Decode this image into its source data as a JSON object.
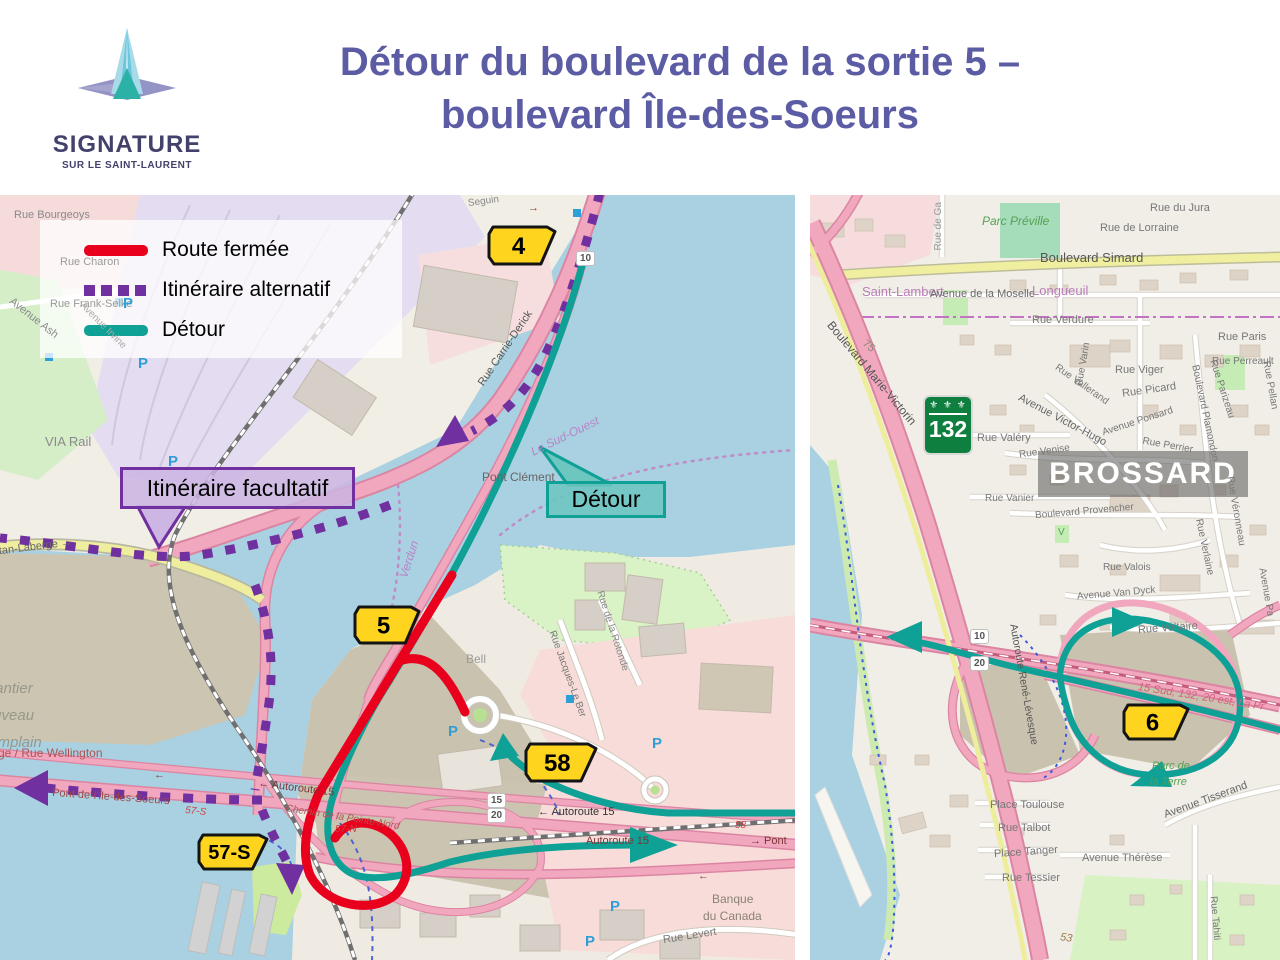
{
  "header": {
    "title_line1": "Détour du boulevard de la sortie 5 –",
    "title_line2": "boulevard Île-des-Soeurs",
    "title_color": "#5c5ca5",
    "logo_name": "SIGNATURE",
    "logo_subtitle": "SUR LE SAINT-LAURENT"
  },
  "palette": {
    "badge_yellow": "#ffd41e",
    "badge_border": "#141414",
    "shield_green": "#0f7f3f"
  },
  "legend": {
    "items": [
      {
        "label": "Route fermée",
        "color": "#e8001d",
        "style": "solid"
      },
      {
        "label": "Itinéraire alternatif",
        "color": "#7030a0",
        "style": "dashed"
      },
      {
        "label": "Détour",
        "color": "#0fa096",
        "style": "solid"
      }
    ]
  },
  "left_map": {
    "callouts": [
      {
        "text": "Itinéraire facultatif",
        "type": "alternative-route-callout"
      },
      {
        "text": "Détour",
        "type": "detour-callout"
      }
    ],
    "badges": [
      {
        "label": "4",
        "x": 487,
        "y": 30,
        "w": 70,
        "h": 41
      },
      {
        "label": "5",
        "x": 353,
        "y": 410,
        "w": 68,
        "h": 40
      },
      {
        "label": "58",
        "x": 524,
        "y": 547,
        "w": 74,
        "h": 41
      },
      {
        "label": "57-S",
        "x": 197,
        "y": 638,
        "w": 72,
        "h": 38
      }
    ],
    "road_plates": [
      {
        "label": "10",
        "x": 576,
        "y": 56
      },
      {
        "label": "15",
        "x": 487,
        "y": 598
      },
      {
        "label": "20",
        "x": 487,
        "y": 613
      }
    ],
    "p_marker_label": "P",
    "p_positions": [
      {
        "x": 123,
        "y": 100
      },
      {
        "x": 138,
        "y": 160
      },
      {
        "x": 168,
        "y": 258
      },
      {
        "x": 448,
        "y": 528
      },
      {
        "x": 652,
        "y": 540
      },
      {
        "x": 610,
        "y": 703
      },
      {
        "x": 585,
        "y": 738
      }
    ],
    "labels": [
      {
        "t": "Rue Bourgeoys",
        "x": 14,
        "y": 15,
        "s": 11,
        "c": "#8a8a8a"
      },
      {
        "t": "Seguin",
        "x": 468,
        "y": 2,
        "s": 10,
        "c": "#888",
        "rot": -8
      },
      {
        "t": "Rue Charon",
        "x": 60,
        "y": 62,
        "s": 11,
        "c": "#9a9a9a"
      },
      {
        "t": "Rue Frank-Selke",
        "x": 50,
        "y": 104,
        "s": 11,
        "c": "#9a9a9a"
      },
      {
        "t": "Avenue Ash",
        "x": 4,
        "y": 118,
        "s": 11,
        "c": "#8a8a8a",
        "rot": 38
      },
      {
        "t": "Avenue Irvine",
        "x": 72,
        "y": 126,
        "s": 10,
        "c": "#aaa",
        "rot": 45
      },
      {
        "t": "VIA Rail",
        "x": 45,
        "y": 240,
        "s": 13,
        "c": "#8a8a8a"
      },
      {
        "t": "Rue Carrie-Derick",
        "x": 462,
        "y": 148,
        "s": 11,
        "c": "#555",
        "rot": -56
      },
      {
        "t": "Pont Clément",
        "x": 482,
        "y": 276,
        "s": 12,
        "c": "#666"
      },
      {
        "t": "Le Sud-Ouest",
        "x": 528,
        "y": 235,
        "s": 12,
        "c": "#b884c8",
        "rot": -26,
        "it": 1
      },
      {
        "t": "Verdun",
        "x": 390,
        "y": 358,
        "s": 12,
        "c": "#b884c8",
        "rot": -72,
        "it": 1
      },
      {
        "t": "Gaétan-Laberge  →",
        "x": -22,
        "y": 348,
        "s": 11,
        "c": "#666",
        "rot": -7
      },
      {
        "t": "Chantier",
        "x": -24,
        "y": 486,
        "s": 15,
        "c": "#98988a",
        "it": 1
      },
      {
        "t": "Nouveau",
        "x": -26,
        "y": 513,
        "s": 15,
        "c": "#98988a",
        "it": 1
      },
      {
        "t": "Champlain",
        "x": -30,
        "y": 540,
        "s": 15,
        "c": "#98988a",
        "it": 1
      },
      {
        "t": "ge / Rue Wellington",
        "x": -2,
        "y": 552,
        "s": 12,
        "c": "#b05353"
      },
      {
        "t": "Pont de-l'Île-des-Soeurs",
        "x": 52,
        "y": 597,
        "s": 11,
        "c": "#a04848",
        "rot": 4
      },
      {
        "t": "57-S",
        "x": 185,
        "y": 612,
        "s": 10,
        "c": "#cc4444",
        "it": 1,
        "rot": 6
      },
      {
        "t": "← Autoroute 15",
        "x": 258,
        "y": 588,
        "s": 11,
        "c": "#7a3535",
        "rot": 7
      },
      {
        "t": "Chemin de la Pointe-Nord",
        "x": 285,
        "y": 618,
        "s": 10,
        "c": "#b05353",
        "it": 1,
        "rot": 9
      },
      {
        "t": "57-N",
        "x": 335,
        "y": 630,
        "s": 10,
        "c": "#cc4444",
        "it": 1
      },
      {
        "t": "← Autoroute 15",
        "x": 538,
        "y": 612,
        "s": 11,
        "c": "#333"
      },
      {
        "t": "58",
        "x": 735,
        "y": 626,
        "s": 10,
        "c": "#cc4444",
        "it": 1
      },
      {
        "t": "Autoroute 15",
        "x": 586,
        "y": 641,
        "s": 11,
        "c": "#7a3535"
      },
      {
        "t": "→ Pont",
        "x": 750,
        "y": 641,
        "s": 11,
        "c": "#7a3535"
      },
      {
        "t": "Bell",
        "x": 466,
        "y": 458,
        "s": 12,
        "c": "#999"
      },
      {
        "t": "Rue Jacques-Le Ber",
        "x": 521,
        "y": 474,
        "s": 10,
        "c": "#777",
        "rot": 70
      },
      {
        "t": "Rue de la Rotonde",
        "x": 570,
        "y": 431,
        "s": 10,
        "c": "#888",
        "rot": 72
      },
      {
        "t": "Banque",
        "x": 712,
        "y": 698,
        "s": 12,
        "c": "#8a8274"
      },
      {
        "t": "du Canada",
        "x": 703,
        "y": 715,
        "s": 12,
        "c": "#8a8274"
      },
      {
        "t": "Rue Levert",
        "x": 663,
        "y": 736,
        "s": 11,
        "c": "#777",
        "rot": -9
      },
      {
        "t": "→",
        "x": 528,
        "y": 8,
        "s": 11,
        "c": "#8a3a3a"
      },
      {
        "t": "←",
        "x": 154,
        "y": 575,
        "s": 11,
        "c": "#8a3a3a"
      },
      {
        "t": "←",
        "x": 698,
        "y": 676,
        "s": 11,
        "c": "#8a3a3a"
      }
    ]
  },
  "right_map": {
    "city_label": "BROSSARD",
    "route_shield": {
      "number": "132",
      "fleur": "⚜ ⚜ ⚜"
    },
    "badges": [
      {
        "label": "6",
        "x": 312,
        "y": 508,
        "w": 68,
        "h": 38
      }
    ],
    "road_plates": [
      {
        "label": "10",
        "x": 160,
        "y": 434
      },
      {
        "label": "20",
        "x": 160,
        "y": 461
      }
    ],
    "labels": [
      {
        "t": "Rue de Ga",
        "x": 105,
        "y": 26,
        "s": 10,
        "c": "#999",
        "rot": -90
      },
      {
        "t": "Parc Préville",
        "x": 172,
        "y": 20,
        "s": 12,
        "c": "#55a055",
        "it": 1
      },
      {
        "t": "Rue du Jura",
        "x": 340,
        "y": 8,
        "s": 11,
        "c": "#777"
      },
      {
        "t": "Rue de Lorraine",
        "x": 290,
        "y": 28,
        "s": 11,
        "c": "#777"
      },
      {
        "t": "Boulevard Simard",
        "x": 230,
        "y": 56,
        "s": 13,
        "c": "#555"
      },
      {
        "t": "Saint-Lambert",
        "x": 52,
        "y": 90,
        "s": 13,
        "c": "#b87eb8"
      },
      {
        "t": "Avenue de la Moselle",
        "x": 120,
        "y": 94,
        "s": 11,
        "c": "#666"
      },
      {
        "t": "Longueuil",
        "x": 222,
        "y": 89,
        "s": 13,
        "c": "#b87eb8"
      },
      {
        "t": "Rue Verdure",
        "x": 222,
        "y": 120,
        "s": 11,
        "c": "#777"
      },
      {
        "t": "Rue Paris",
        "x": 408,
        "y": 137,
        "s": 11,
        "c": "#777"
      },
      {
        "t": "75",
        "x": 52,
        "y": 146,
        "s": 11,
        "c": "#8a8a70",
        "rot": 40
      },
      {
        "t": "Boulevard Marie-Victorin",
        "x": -4,
        "y": 172,
        "s": 12,
        "c": "#555",
        "rot": 50
      },
      {
        "t": "Rue Varin",
        "x": 252,
        "y": 164,
        "s": 10,
        "c": "#777",
        "rot": -80
      },
      {
        "t": "Rue Viger",
        "x": 305,
        "y": 170,
        "s": 11,
        "c": "#777"
      },
      {
        "t": "Rue Vallerand",
        "x": 240,
        "y": 185,
        "s": 10,
        "c": "#777",
        "rot": 35
      },
      {
        "t": "Rue Picard",
        "x": 312,
        "y": 190,
        "s": 11,
        "c": "#777",
        "rot": -8
      },
      {
        "t": "Rue Perreault",
        "x": 402,
        "y": 162,
        "s": 10,
        "c": "#777"
      },
      {
        "t": "Rue Parizeau",
        "x": 381,
        "y": 189,
        "s": 10,
        "c": "#777",
        "rot": 72
      },
      {
        "t": "Rue Pellan",
        "x": 435,
        "y": 185,
        "s": 10,
        "c": "#777",
        "rot": 80
      },
      {
        "t": "Boulevard Plamondon",
        "x": 345,
        "y": 213,
        "s": 10,
        "c": "#777",
        "rot": 78
      },
      {
        "t": "Avenue Victor-Hugo",
        "x": 203,
        "y": 220,
        "s": 11,
        "c": "#666",
        "rot": 28
      },
      {
        "t": "Avenue Ponsard",
        "x": 291,
        "y": 222,
        "s": 10,
        "c": "#777",
        "rot": -18
      },
      {
        "t": "Rue Valéry",
        "x": 167,
        "y": 238,
        "s": 11,
        "c": "#777"
      },
      {
        "t": "Rue Perrier",
        "x": 332,
        "y": 246,
        "s": 10,
        "c": "#777",
        "rot": 10
      },
      {
        "t": "Rue Venise",
        "x": 209,
        "y": 252,
        "s": 10,
        "c": "#777",
        "rot": -8
      },
      {
        "t": "V",
        "x": 248,
        "y": 333,
        "s": 10,
        "c": "#55a055"
      },
      {
        "t": "Rue Vanier",
        "x": 175,
        "y": 299,
        "s": 10,
        "c": "#777"
      },
      {
        "t": "Boulevard Provencher",
        "x": 225,
        "y": 312,
        "s": 10,
        "c": "#777",
        "rot": -5
      },
      {
        "t": "Rue Véronneau",
        "x": 390,
        "y": 311,
        "s": 10,
        "c": "#777",
        "rot": 80
      },
      {
        "t": "Rue Valois",
        "x": 293,
        "y": 368,
        "s": 10,
        "c": "#777"
      },
      {
        "t": "Rue Verlaine",
        "x": 365,
        "y": 347,
        "s": 10,
        "c": "#777",
        "rot": 78
      },
      {
        "t": "Avenue Van Dyck",
        "x": 267,
        "y": 394,
        "s": 10,
        "c": "#777",
        "rot": -5
      },
      {
        "t": "Avenue Pa",
        "x": 431,
        "y": 392,
        "s": 10,
        "c": "#777",
        "rot": 80
      },
      {
        "t": "Rue Voltaire",
        "x": 328,
        "y": 428,
        "s": 11,
        "c": "#777",
        "rot": -4
      },
      {
        "t": "Autoroute René-Lévesque",
        "x": 152,
        "y": 484,
        "s": 10.5,
        "c": "#555",
        "rot": 80
      },
      {
        "t": "15 Sud, 132, 20 est, La Pr",
        "x": 327,
        "y": 497,
        "s": 11,
        "c": "#d4607a",
        "it": 1,
        "rot": 9
      },
      {
        "t": "Parc de",
        "x": 342,
        "y": 566,
        "s": 11,
        "c": "#55a055",
        "it": 1
      },
      {
        "t": "la Terre",
        "x": 340,
        "y": 582,
        "s": 11,
        "c": "#55a055",
        "it": 1
      },
      {
        "t": "Avenue Tisserand",
        "x": 352,
        "y": 600,
        "s": 11,
        "c": "#666",
        "rot": -20
      },
      {
        "t": "Place Toulouse",
        "x": 180,
        "y": 605,
        "s": 11,
        "c": "#777"
      },
      {
        "t": "Rue Talbot",
        "x": 188,
        "y": 628,
        "s": 11,
        "c": "#777"
      },
      {
        "t": "Place Tanger",
        "x": 184,
        "y": 652,
        "s": 11,
        "c": "#777",
        "rot": -4
      },
      {
        "t": "Rue Tessier",
        "x": 192,
        "y": 678,
        "s": 11,
        "c": "#777"
      },
      {
        "t": "Avenue Thérèse",
        "x": 272,
        "y": 658,
        "s": 11,
        "c": "#777"
      },
      {
        "t": "Rue Tahiti",
        "x": 382,
        "y": 718,
        "s": 10,
        "c": "#777",
        "rot": 85
      },
      {
        "t": "53",
        "x": 250,
        "y": 738,
        "s": 11,
        "c": "#9a7a4a",
        "it": 1,
        "rot": 8
      }
    ]
  }
}
